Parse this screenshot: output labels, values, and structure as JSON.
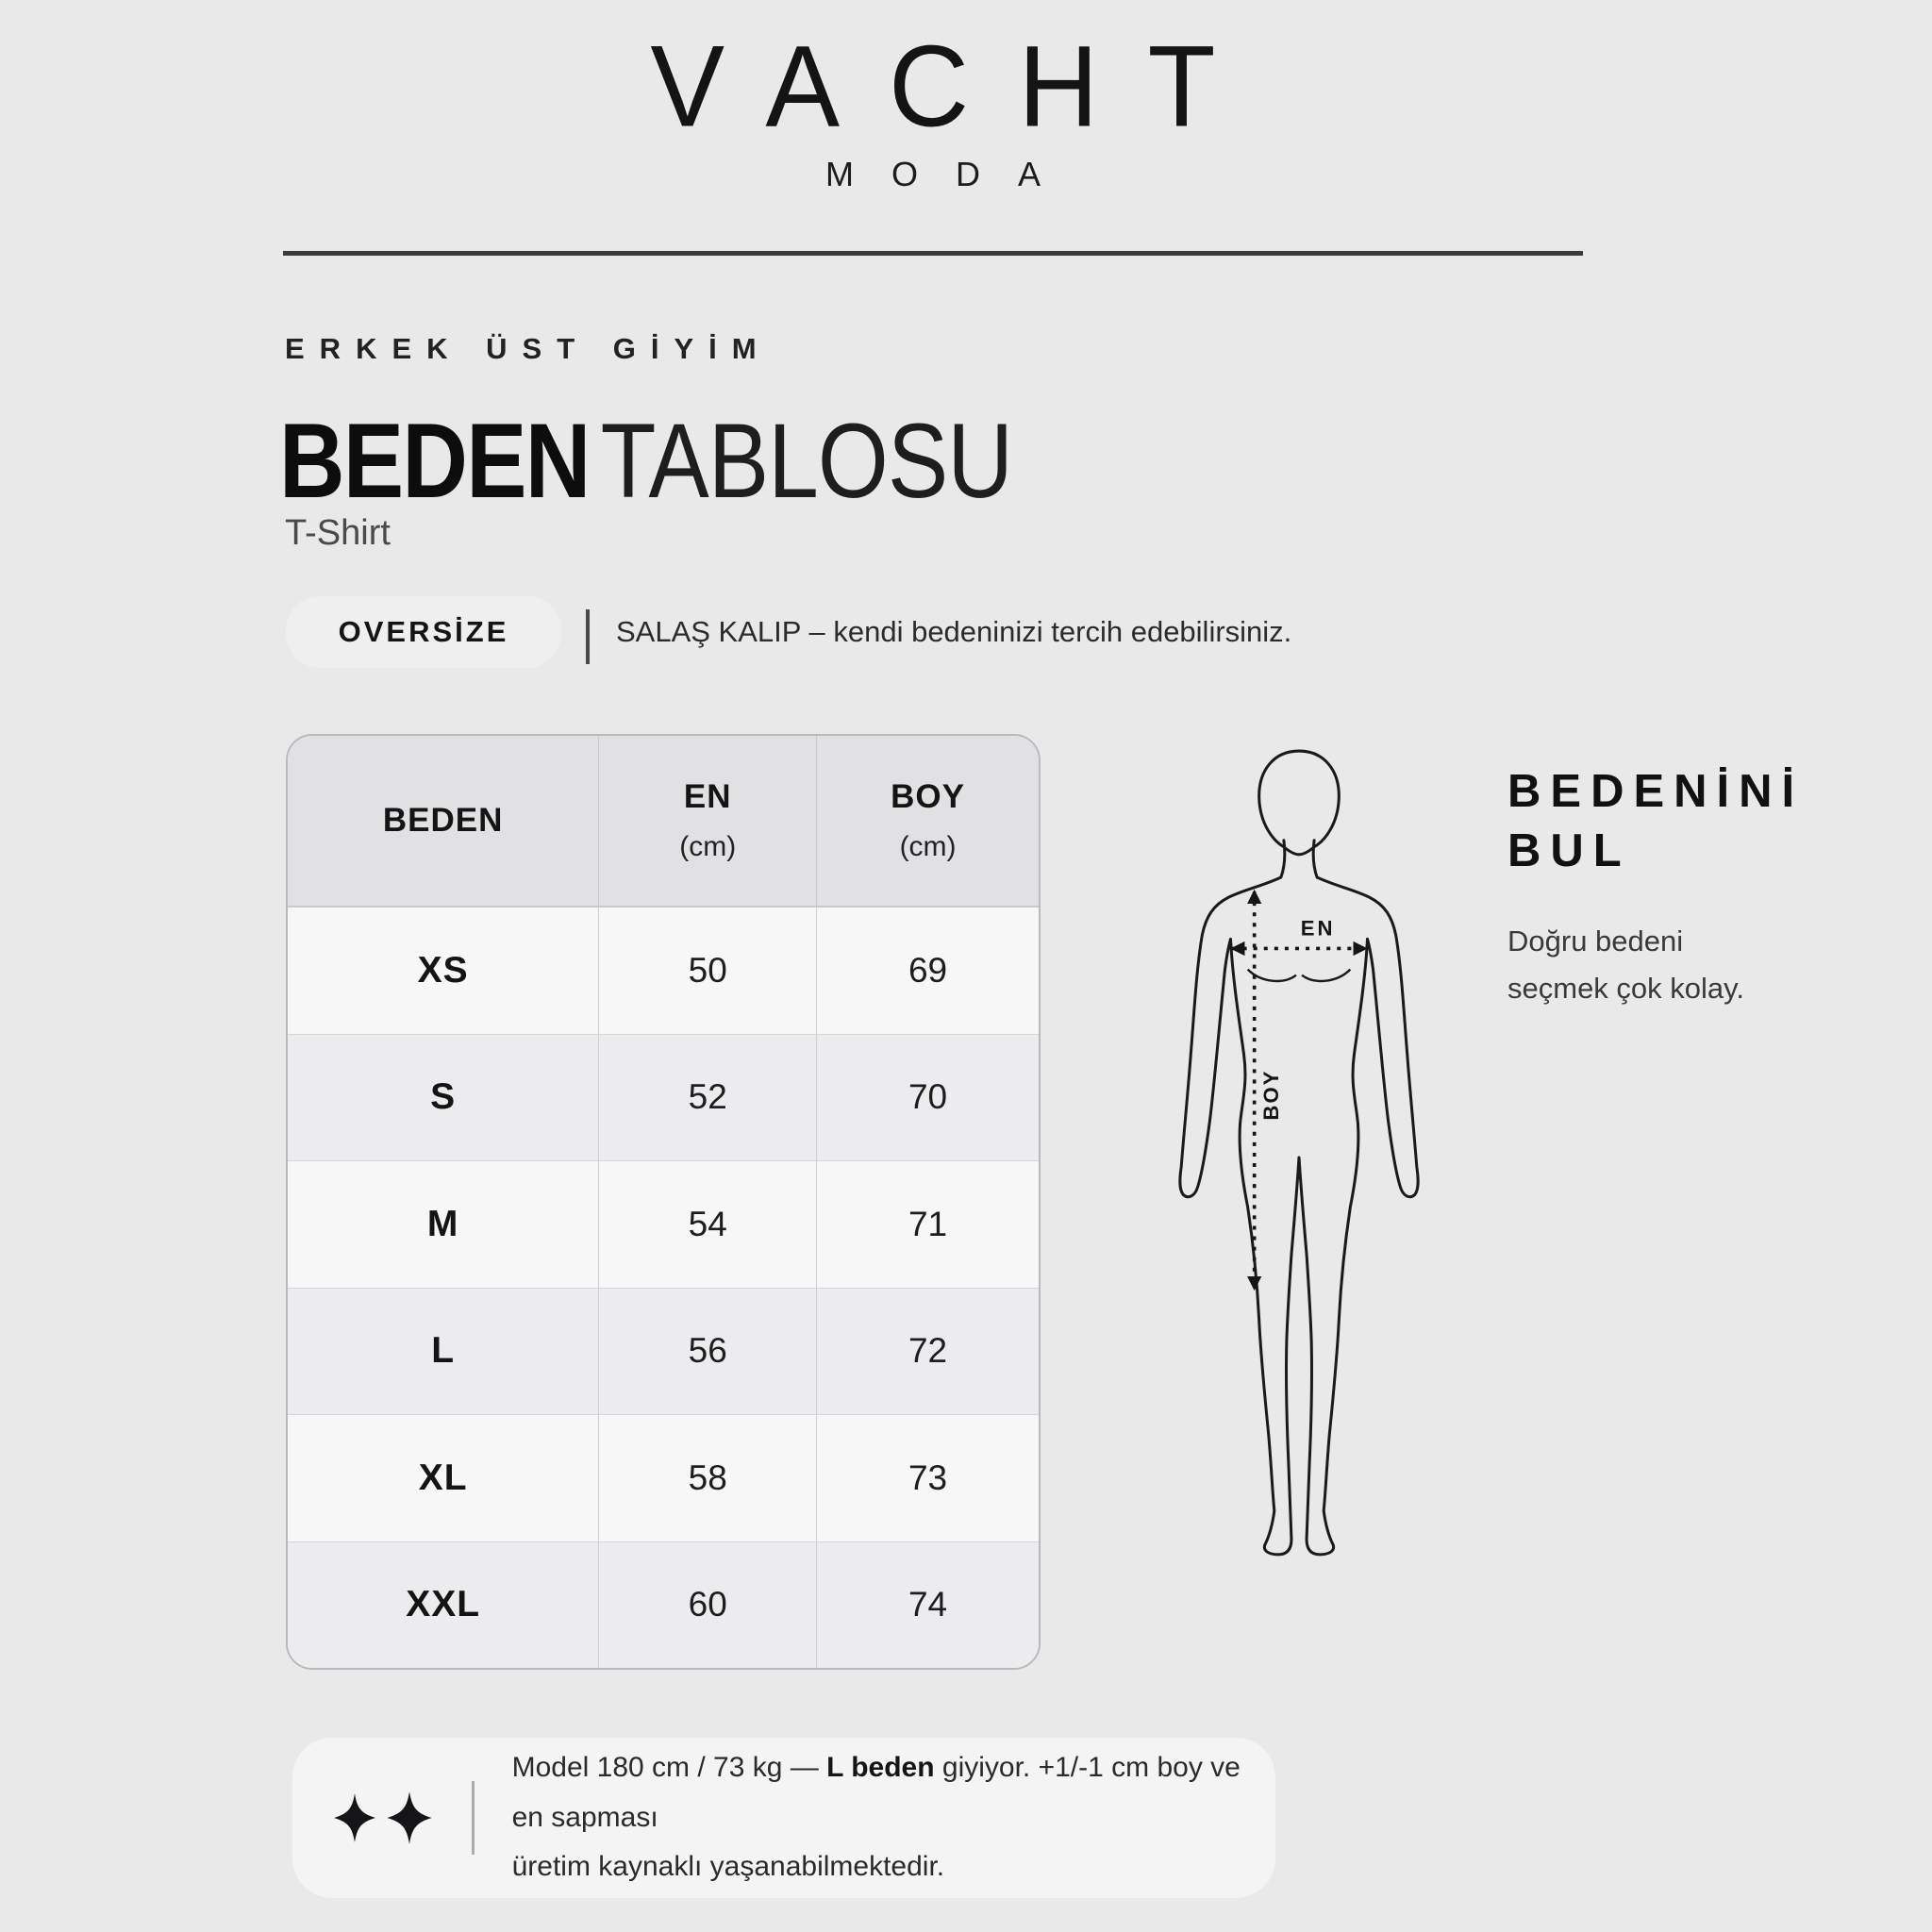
{
  "brand": {
    "name": "VACHT",
    "subtitle": "MODA"
  },
  "header": {
    "category": "ERKEK ÜST GİYİM",
    "title_bold": "BEDEN",
    "title_light": "TABLOSU",
    "product": "T-Shirt"
  },
  "fit": {
    "badge": "OVERSİZE",
    "text": "SALAŞ KALIP – kendi bedeninizi tercih edebilirsiniz."
  },
  "size_table": {
    "col_size": "BEDEN",
    "col_en": "EN",
    "col_en_unit": "(cm)",
    "col_boy": "BOY",
    "col_boy_unit": "(cm)",
    "rows": [
      {
        "size": "XS",
        "en": "50",
        "boy": "69"
      },
      {
        "size": "S",
        "en": "52",
        "boy": "70"
      },
      {
        "size": "M",
        "en": "54",
        "boy": "71"
      },
      {
        "size": "L",
        "en": "56",
        "boy": "72"
      },
      {
        "size": "XL",
        "en": "58",
        "boy": "73"
      },
      {
        "size": "XXL",
        "en": "60",
        "boy": "74"
      }
    ]
  },
  "figure": {
    "en_label": "EN",
    "boy_label": "BOY"
  },
  "find_size": {
    "heading_line1": "BEDENİNİ",
    "heading_line2": "BUL",
    "desc_line1": "Doğru bedeni",
    "desc_line2": "seçmek çok kolay."
  },
  "footer": {
    "text_before": "Model 180 cm / 73 kg — ",
    "text_bold": "L beden",
    "text_after": " giyiyor. +1/-1 cm boy ve en sapması",
    "text_line2": "üretim kaynaklı yaşanabilmektedir."
  },
  "colors": {
    "page_bg": "#e9e9e9",
    "text_main": "#1a1a1a",
    "rule_dark": "#3a3a3a",
    "badge_bg": "#efeff0",
    "table_header_bg": "#e1e1e3",
    "table_row_light": "#f7f7f8",
    "table_row_dark": "#ececee",
    "table_border": "#b9b9bd",
    "footer_card_bg": "#f4f4f5"
  }
}
